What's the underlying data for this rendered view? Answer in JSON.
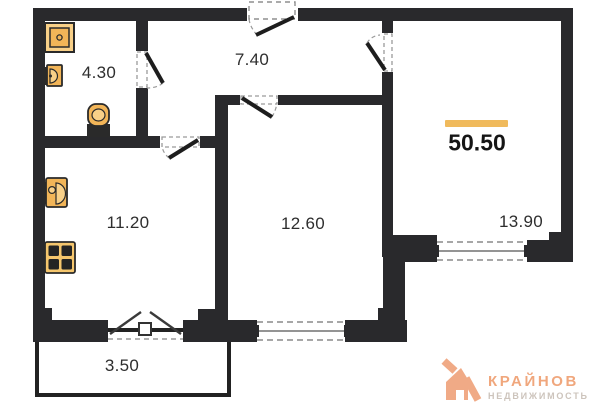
{
  "plan": {
    "total": {
      "area": "50.50"
    },
    "rooms": {
      "bathroom": {
        "area": "4.30"
      },
      "hallway": {
        "area": "7.40"
      },
      "kitchen": {
        "area": "11.20"
      },
      "bedroom": {
        "area": "12.60"
      },
      "living_room": {
        "area": "13.90"
      },
      "balcony": {
        "area": "3.50"
      }
    },
    "fixtures": [
      "shower-icon",
      "washbasin-icon",
      "toilet-icon",
      "kitchen-sink-icon",
      "stove-icon"
    ],
    "openings": [
      "entrance-door",
      "bathroom-door",
      "kitchen-door",
      "bedroom-door",
      "living-room-door",
      "balcony-door",
      "bedroom-window",
      "living-room-window"
    ]
  },
  "colors": {
    "wall": "#29292c",
    "fixture_light": "#f8d088",
    "fixture_mid": "#f2b558",
    "accent_bar": "#f0ba5c",
    "label_text": "#2e2e2e",
    "logo_orange": "#ee9c72",
    "logo_text_orange": "#f0a77d",
    "logo_text_gray": "#cdc4bc"
  },
  "logo": {
    "brand": "КРАЙНОВ",
    "tagline": "НЕДВИЖИМОСТЬ"
  }
}
